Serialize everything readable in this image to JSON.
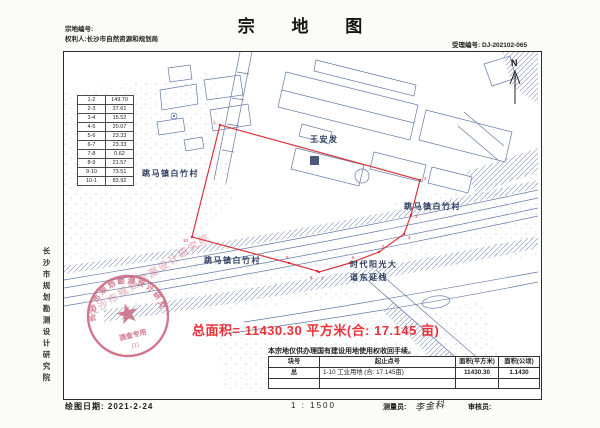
{
  "page": {
    "title": "宗 地 图"
  },
  "header": {
    "parcel_no_label": "宗地编号:",
    "holder": "权利人:长沙市自然资源和规划局",
    "acceptance": "受理编号: DJ-202102-065"
  },
  "sidebar": {
    "org": "长沙市规划勘测设计研究院"
  },
  "side_table": {
    "rows": [
      [
        "1-2",
        "149.70"
      ],
      [
        "2-3",
        "27.61"
      ],
      [
        "3-4",
        "15.52"
      ],
      [
        "4-5",
        "20.07"
      ],
      [
        "5-6",
        "23.33"
      ],
      [
        "6-7",
        "23.33"
      ],
      [
        "7-8",
        "0.62"
      ],
      [
        "8-9",
        "21.57"
      ],
      [
        "9-10",
        "73.51"
      ],
      [
        "10-1",
        "83.92"
      ]
    ]
  },
  "map": {
    "north_label": "N",
    "labels": [
      {
        "text": "跳马镇白竹村",
        "x": 78,
        "y": 124
      },
      {
        "text": "王安发",
        "x": 246,
        "y": 90
      },
      {
        "text": "跳马镇白竹村",
        "x": 340,
        "y": 157
      },
      {
        "text": "跳马镇白竹村",
        "x": 140,
        "y": 211
      },
      {
        "text": "时代阳光大",
        "x": 286,
        "y": 215
      },
      {
        "text": "道东延线",
        "x": 286,
        "y": 228
      }
    ],
    "boundary_points": "156,73 356,128 347,163 340,182 315,200 286,211 255,220 253,219 225,211 128,185",
    "vertex_offsets": [
      [
        -7,
        -1
      ],
      [
        4,
        0
      ],
      [
        4,
        3
      ],
      [
        4,
        5
      ],
      [
        3,
        -4
      ],
      [
        2,
        -4
      ],
      [
        2,
        8
      ],
      [
        -7,
        8
      ],
      [
        -3,
        -4
      ],
      [
        -9,
        5
      ]
    ],
    "area_text": "总面积= 11430.30 平方米(合: 17.145 亩)"
  },
  "seal": {
    "arc_text": "长沙市规划勘测设计研究院",
    "inner_text": "调查专用",
    "number": "(1)"
  },
  "note": "本宗地仅供办理国有建设用地使用权收回手续。",
  "bottom_table": {
    "headers": [
      "块号",
      "起止点号",
      "面积(平方米)",
      "面积(公顷)"
    ],
    "rows": [
      [
        "总",
        "1-10  工业用地    (合: 17.145亩)",
        "11430.30",
        "1.1430"
      ]
    ]
  },
  "footer": {
    "date": "绘图日期: 2021-2-24",
    "scale": "1 : 1500",
    "surveyor_label": "测量员:",
    "surveyor_signature": "李金科",
    "reviewer_label": "审核员:"
  },
  "colors": {
    "boundary_red": "#d9363c",
    "area_red": "#e8333a",
    "map_blue": "#6478a6",
    "seal_pink": "#c9607a"
  }
}
